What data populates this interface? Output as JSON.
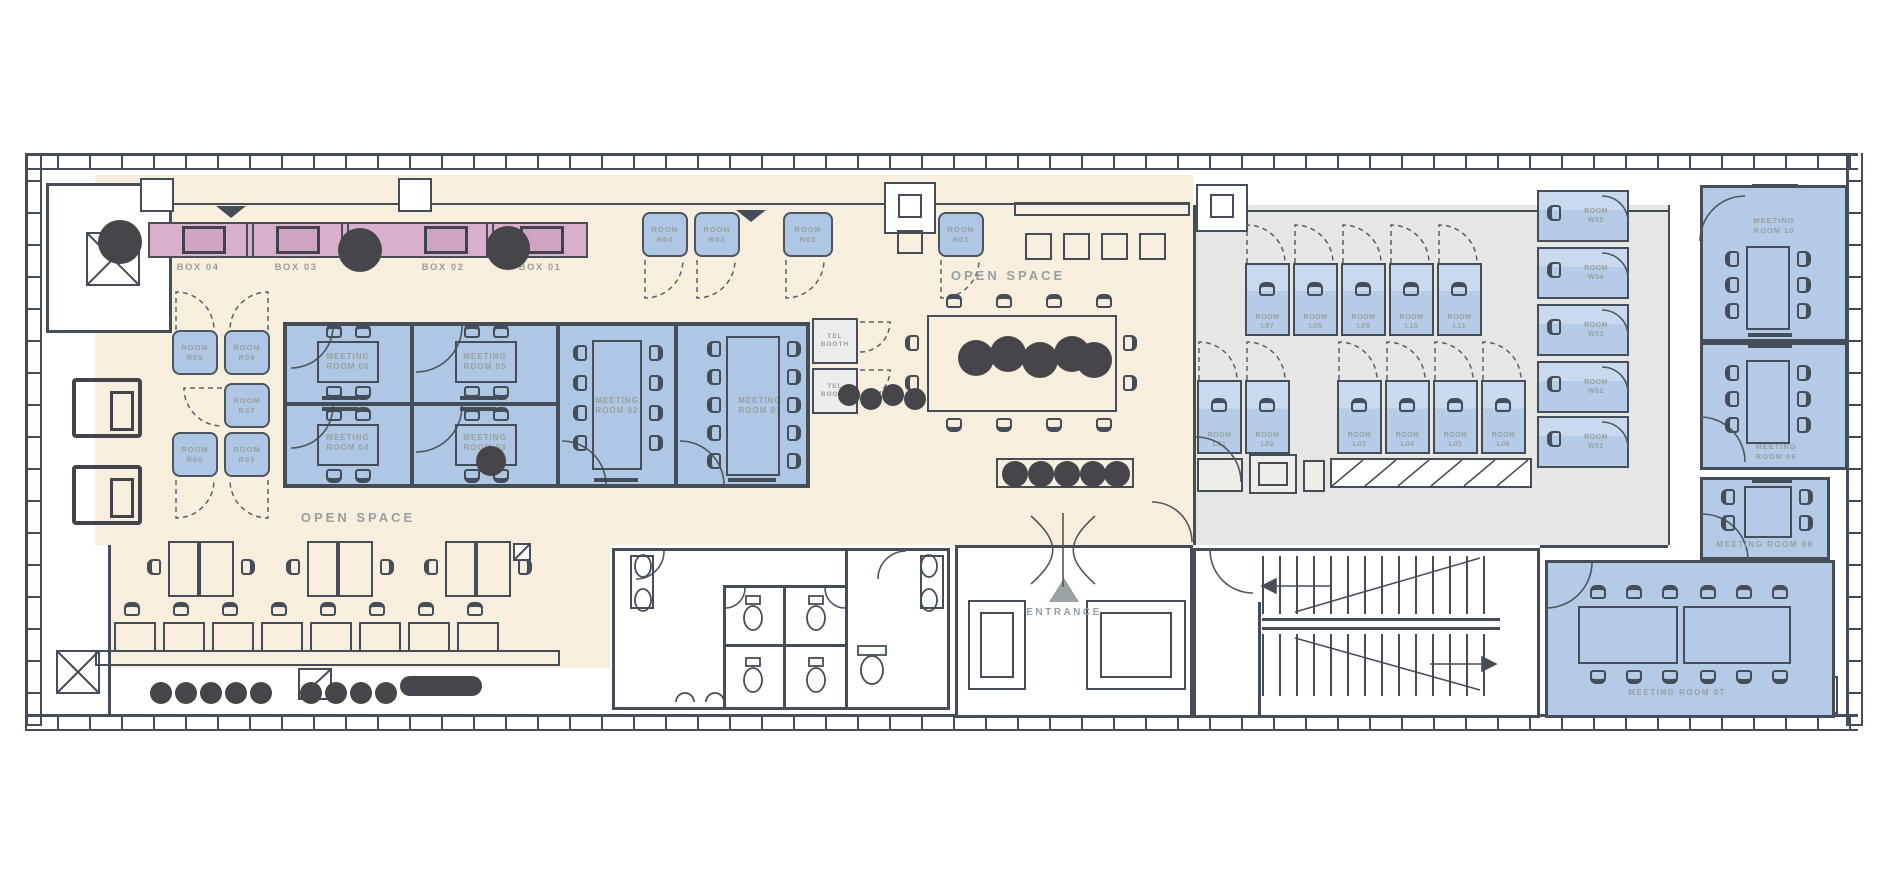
{
  "labels": {
    "open_space": "OPEN SPACE",
    "open_space2": "OPEN SPACE",
    "entrance": "ENTRANCE",
    "boxes": [
      "BOX 04",
      "BOX 03",
      "BOX 02",
      "BOX 01"
    ],
    "r_top": [
      "ROOM\nR04",
      "ROOM\nR03",
      "ROOM\nR02",
      "ROOM\nR01"
    ],
    "r_left": [
      "ROOM\nR09",
      "ROOM\nR08",
      "ROOM\nR07",
      "ROOM\nR06",
      "ROOM\nR05"
    ],
    "meet_left": [
      "MEETING\nROOM 06",
      "MEETING\nROOM 05",
      "MEETING\nROOM 04",
      "MEETING\nROOM 03",
      "MEETING\nROOM 02",
      "MEETING\nROOM 01"
    ],
    "tel": [
      "TEL\nBOOTH",
      "TEL\nBOOTH"
    ],
    "l_top": [
      "ROOM\nL07",
      "ROOM\nL08",
      "ROOM\nL09",
      "ROOM\nL10",
      "ROOM\nL11"
    ],
    "l_bottom": [
      "ROOM\nL01",
      "ROOM\nL02",
      "ROOM\nL03",
      "ROOM\nL04",
      "ROOM\nL05",
      "ROOM\nL06"
    ],
    "w": [
      "ROOM\nW05",
      "ROOM\nW04",
      "ROOM\nW03",
      "ROOM\nW02",
      "ROOM\nW01"
    ],
    "meet_right": [
      "MEETING\nROOM 10",
      "MEETING\nROOM 09",
      "MEETING ROOM 08",
      "MEETING ROOM 07"
    ]
  },
  "icons": {
    "entrance_marker": "triangle-up",
    "stairs": "stair-flights",
    "elevator": "elevator-shaft",
    "plants": "plant-blob",
    "terrace": "crossed-square"
  },
  "colors": {
    "wall": "#454e58",
    "cream": "#f7eedd",
    "room_blue": "#adc7e4",
    "focus_blue": "#b5cce9",
    "pink": "#d8b0cb",
    "gray_zone": "#e6e6e4",
    "label_gray": "#98a09f",
    "plant_dark": "#46464a"
  }
}
